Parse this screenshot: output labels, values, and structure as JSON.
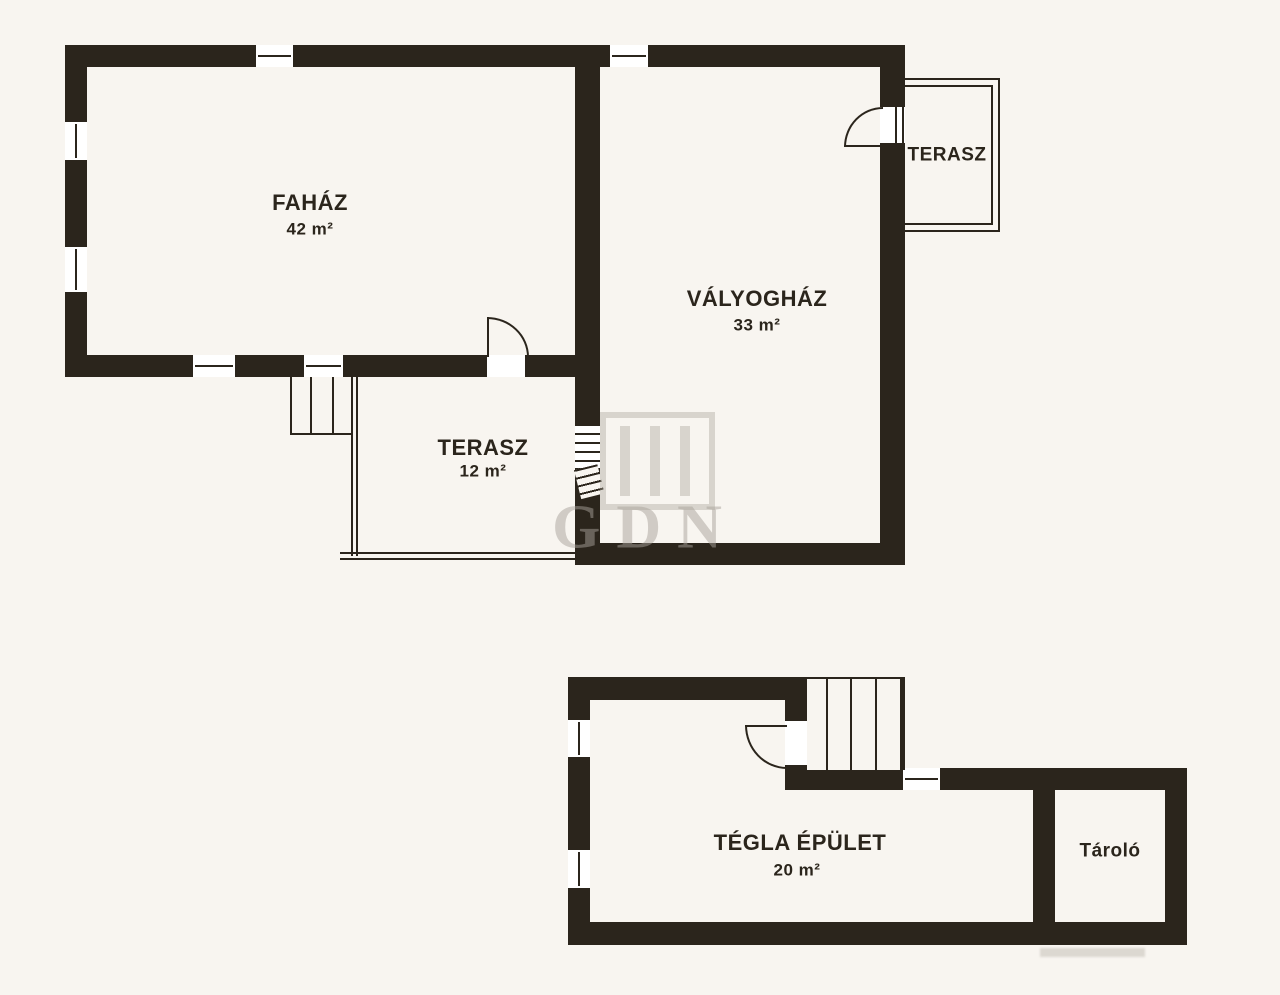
{
  "colors": {
    "background": "#f8f5f0",
    "wall": "#2b251c",
    "label_text": "#2b251c",
    "watermark": "#a8a299"
  },
  "rooms": {
    "fahaz": {
      "name": "FAHÁZ",
      "area": "42 m²"
    },
    "valyoghaz": {
      "name": "VÁLYOGHÁZ",
      "area": "33 m²"
    },
    "terasz_top": {
      "name": "TERASZ"
    },
    "terasz_mid": {
      "name": "TERASZ",
      "area": "12 m²"
    },
    "tegla_epulet": {
      "name": "TÉGLA ÉPÜLET",
      "area": "20 m²"
    },
    "tarolo": {
      "name": "Tároló"
    }
  },
  "watermark": {
    "text": "GDN"
  }
}
